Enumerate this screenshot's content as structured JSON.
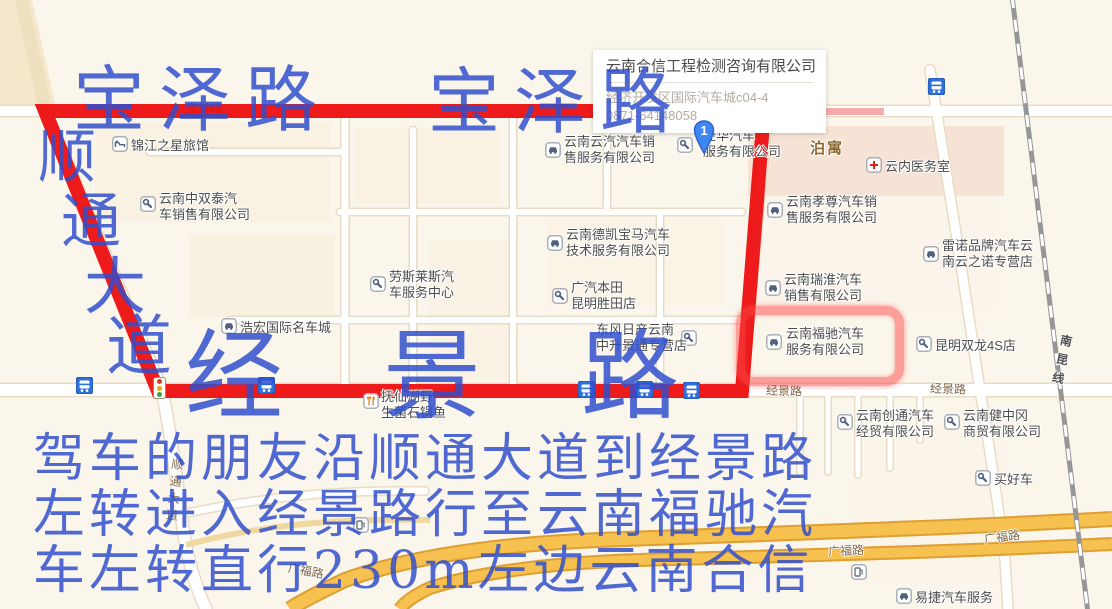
{
  "popup": {
    "title": "云南合信工程检测咨询有限公司",
    "address": "经济开发区国际汽车城c04-4",
    "phone": "0871-64148058",
    "marker_label": "1"
  },
  "annotations": {
    "color": "#2f4dcd",
    "route_color": "#ec0a0a",
    "highlight_color": "#fd4646",
    "street_top_left": "宝泽路",
    "street_top_right": "宝泽路",
    "street_left_vertical": [
      "顺",
      "通",
      "大",
      "道"
    ],
    "street_bottom": "经景路",
    "instruction_lines": [
      "驾车的朋友沿顺通大道到经景路",
      "左转进入经景路行至云南福驰汽",
      "车左转直行230m左边云南合信"
    ]
  },
  "map": {
    "road_labels": [
      {
        "text": "宝泽路",
        "x": 186,
        "y": 99,
        "vertical": false,
        "rotate": 0,
        "cls": ""
      },
      {
        "text": "经景路",
        "x": 766,
        "y": 382,
        "vertical": false,
        "rotate": 2,
        "cls": ""
      },
      {
        "text": "经景路",
        "x": 930,
        "y": 380,
        "vertical": false,
        "rotate": 2,
        "cls": ""
      },
      {
        "text": "广福路",
        "x": 288,
        "y": 562,
        "vertical": false,
        "rotate": 11,
        "cls": ""
      },
      {
        "text": "广福路",
        "x": 828,
        "y": 542,
        "vertical": false,
        "rotate": -3,
        "cls": ""
      },
      {
        "text": "广福路",
        "x": 984,
        "y": 528,
        "vertical": false,
        "rotate": -7,
        "cls": ""
      },
      {
        "text": "南昆线",
        "x": 1053,
        "y": 334,
        "vertical": true,
        "rotate": 12,
        "cls": "rail"
      },
      {
        "text": "顺通大道",
        "x": 166,
        "y": 458,
        "vertical": true,
        "rotate": 6,
        "cls": ""
      }
    ],
    "pois": [
      {
        "icon": "hotel",
        "ix": 112,
        "iy": 136,
        "tx": 131,
        "ty": 138,
        "lines": [
          "锦江之星旅馆"
        ]
      },
      {
        "icon": "wrench",
        "ix": 140,
        "iy": 196,
        "tx": 159,
        "ty": 191,
        "lines": [
          "云南中双泰汽",
          "车销售有限公司"
        ]
      },
      {
        "icon": "car",
        "ix": 545,
        "iy": 142,
        "tx": 564,
        "ty": 134,
        "lines": [
          "云南云汽汽车销",
          "售服务有限公司"
        ]
      },
      {
        "icon": "wrench",
        "ix": 677,
        "iy": 137,
        "tx": 703,
        "ty": 128,
        "lines": [
          "经华汽车",
          "服务有限公司"
        ]
      },
      {
        "icon": "",
        "ix": 0,
        "iy": 0,
        "tx": 810,
        "ty": 141,
        "lines": [
          "泊寓"
        ],
        "cls": "area"
      },
      {
        "icon": "cross",
        "ix": 866,
        "iy": 157,
        "tx": 885,
        "ty": 159,
        "lines": [
          "云内医务室"
        ]
      },
      {
        "icon": "car",
        "ix": 767,
        "iy": 202,
        "tx": 786,
        "ty": 194,
        "lines": [
          "云南孝尊汽车销",
          "售服务有限公司"
        ]
      },
      {
        "icon": "car",
        "ix": 547,
        "iy": 235,
        "tx": 566,
        "ty": 227,
        "lines": [
          "云南德凯宝马汽车",
          "技术服务有限公司"
        ]
      },
      {
        "icon": "wrench",
        "ix": 370,
        "iy": 276,
        "tx": 389,
        "ty": 269,
        "lines": [
          "劳斯莱斯汽",
          "车服务中心"
        ]
      },
      {
        "icon": "car",
        "ix": 923,
        "iy": 246,
        "tx": 942,
        "ty": 238,
        "lines": [
          "雷诺品牌汽车云",
          "南云之诺专营店"
        ]
      },
      {
        "icon": "car",
        "ix": 765,
        "iy": 280,
        "tx": 784,
        "ty": 272,
        "lines": [
          "云南瑞淮汽车",
          "销售有限公司"
        ]
      },
      {
        "icon": "wrench",
        "ix": 552,
        "iy": 288,
        "tx": 571,
        "ty": 280,
        "lines": [
          "广汽本田",
          "昆明胜田店"
        ]
      },
      {
        "icon": "car",
        "ix": 221,
        "iy": 318,
        "tx": 240,
        "ty": 320,
        "lines": [
          "浩宏国际名车城"
        ]
      },
      {
        "icon": "wrench",
        "ix": 681,
        "iy": 330,
        "tx": 596,
        "ty": 322,
        "lines": [
          "东风日产云南",
          "中升景通专营店"
        ]
      },
      {
        "icon": "car",
        "ix": 766,
        "iy": 334,
        "tx": 786,
        "ty": 326,
        "lines": [
          "云南福驰汽车",
          "服务有限公司"
        ]
      },
      {
        "icon": "wrench",
        "ix": 916,
        "iy": 336,
        "tx": 935,
        "ty": 338,
        "lines": [
          "昆明双龙4S店"
        ]
      },
      {
        "icon": "food",
        "ix": 363,
        "iy": 393,
        "tx": 381,
        "ty": 389,
        "lines": [
          "抚仙湖野",
          "生菌石锅鱼"
        ]
      },
      {
        "icon": "wrench",
        "ix": 837,
        "iy": 414,
        "tx": 856,
        "ty": 408,
        "lines": [
          "云南创通汽车",
          "经贸有限公司"
        ]
      },
      {
        "icon": "wrench",
        "ix": 944,
        "iy": 414,
        "tx": 963,
        "ty": 408,
        "lines": [
          "云南健中冈",
          "商贸有限公司"
        ]
      },
      {
        "icon": "wrench",
        "ix": 975,
        "iy": 470,
        "tx": 994,
        "ty": 472,
        "lines": [
          "买好车"
        ]
      },
      {
        "icon": "car",
        "ix": 896,
        "iy": 588,
        "tx": 915,
        "ty": 590,
        "lines": [
          "易捷汽车服务"
        ]
      }
    ],
    "bus_stops": [
      {
        "x": 76,
        "y": 377
      },
      {
        "x": 258,
        "y": 377
      },
      {
        "x": 578,
        "y": 381
      },
      {
        "x": 636,
        "y": 381
      },
      {
        "x": 683,
        "y": 382
      },
      {
        "x": 928,
        "y": 78
      }
    ],
    "gas_stations": [
      {
        "x": 353,
        "y": 517
      },
      {
        "x": 851,
        "y": 564
      }
    ],
    "traffic_light": {
      "x": 153,
      "y": 377
    }
  }
}
